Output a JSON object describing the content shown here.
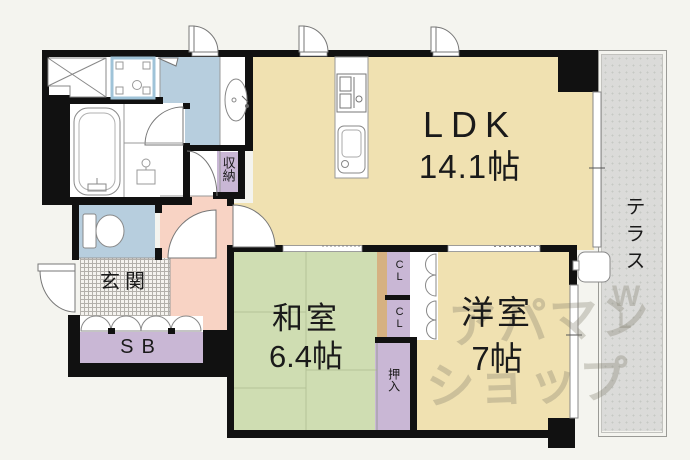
{
  "title": "マンション間取り図",
  "rooms": {
    "ldk": {
      "label": "LDK",
      "size": "14.1帖"
    },
    "washitsu": {
      "label": "和室",
      "size": "6.4帖"
    },
    "youshitsu": {
      "label": "洋室",
      "size": "7帖"
    },
    "genkan": {
      "label": "玄関"
    },
    "terrace": {
      "label": "テラス"
    }
  },
  "storage": {
    "sb": "SB",
    "shuunou": "収納",
    "cl": "CL",
    "oshiire": "押入"
  },
  "watermark": {
    "line1": "アパマン",
    "line2": "ショップ",
    "mark": "W",
    "mark2": "L"
  },
  "palette": {
    "wall": "#111111",
    "ldk_tan": "#f0e1b1",
    "washitsu_green": "#cfddb2",
    "water_blue": "#b7cede",
    "hall_pink": "#f8d3c4",
    "closet_purple": "#c9b7d5",
    "terrace_gray": "#dbdbd9",
    "wood_strip": "#d6b181",
    "washer_pan_blue": "#9fc3d8",
    "exterior": "#f4f4ef"
  }
}
